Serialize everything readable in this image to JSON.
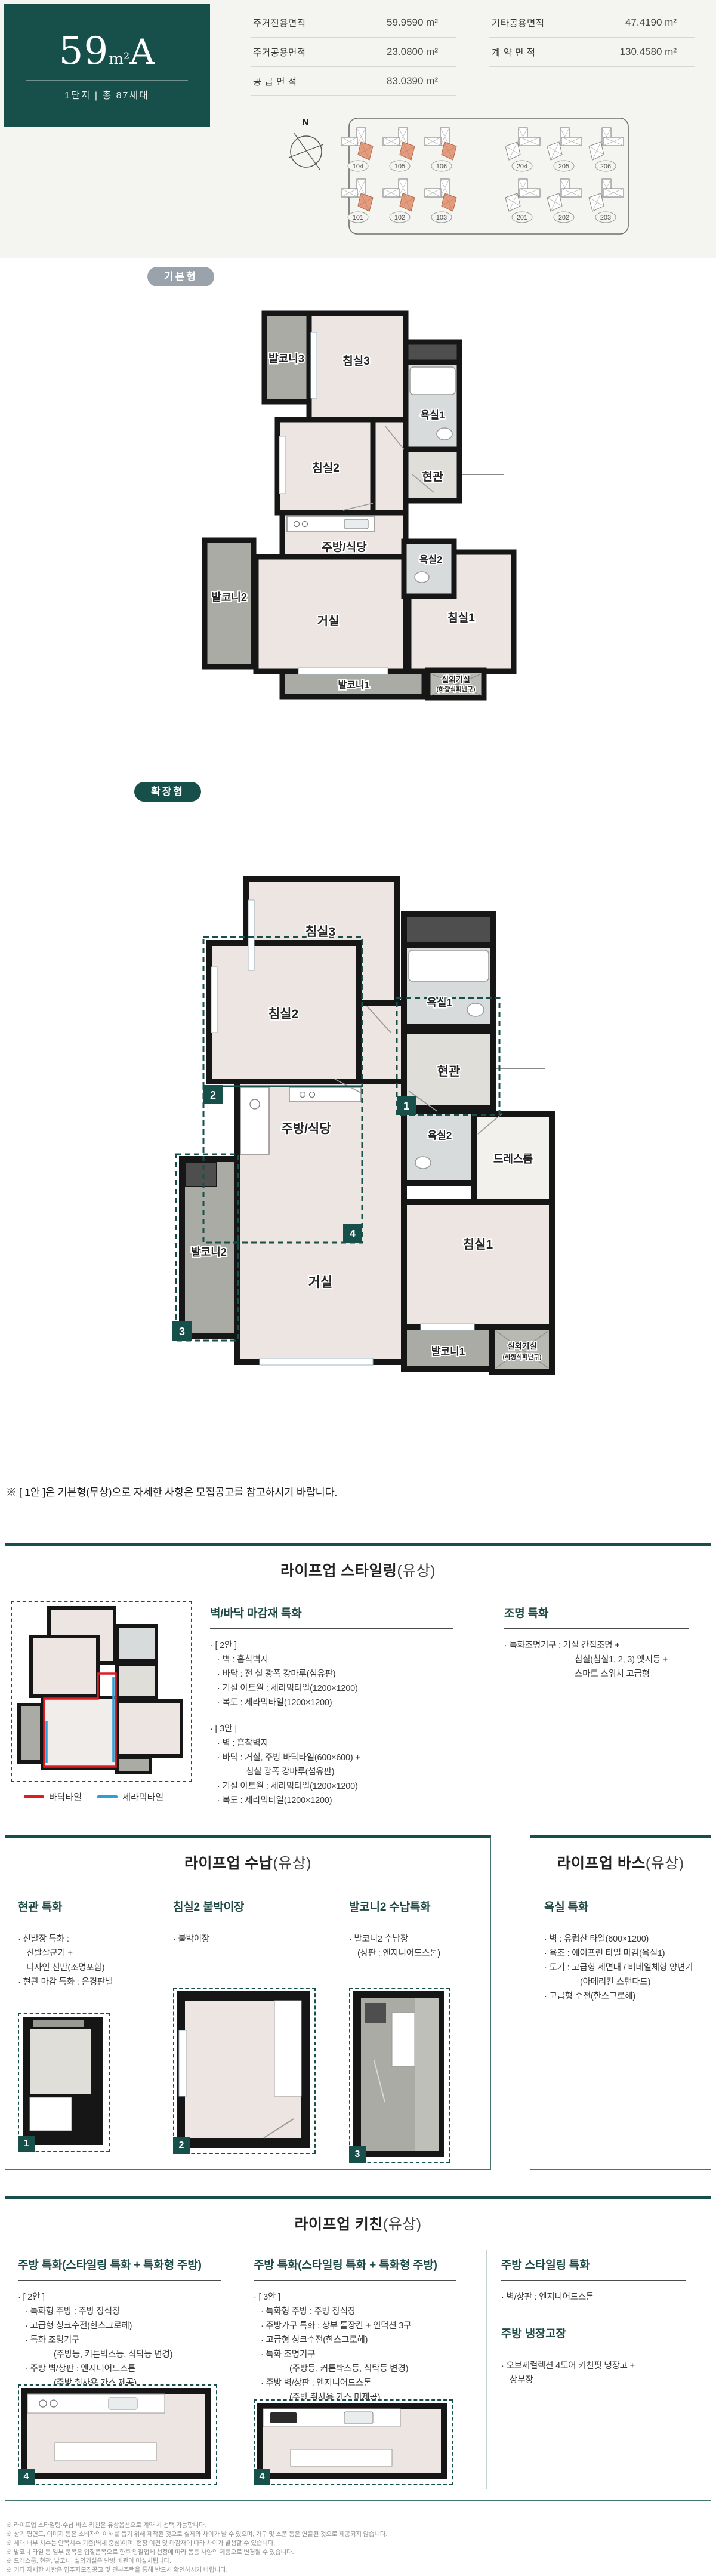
{
  "colors": {
    "accent": "#17504B",
    "badge_gray": "#9AA3AB",
    "building_highlight": "#E59B7E",
    "tile_red": "#E01B22",
    "tile_blue": "#2D9FD8"
  },
  "header": {
    "unit_num": "59",
    "unit_sup": "m²",
    "unit_type": "A",
    "subtitle": "1단지  |  총 87세대",
    "table": {
      "rows": [
        {
          "l1": "주거전용면적",
          "v1": "59.9590 m²",
          "l2": "기타공용면적",
          "v2": "47.4190 m²"
        },
        {
          "l1": "주거공용면적",
          "v1": "23.0800 m²",
          "l2": "계 약 면 적",
          "v2": "130.4580 m²"
        },
        {
          "l1": "공 급 면 적",
          "v1": "83.0390 m²",
          "l2": "",
          "v2": ""
        }
      ]
    },
    "compass": "N",
    "siteplan": {
      "top_row": [
        "104",
        "105",
        "106",
        "204",
        "205",
        "206"
      ],
      "bottom_row": [
        "101",
        "102",
        "103",
        "201",
        "202",
        "203"
      ]
    }
  },
  "badges": {
    "basic": "기본형",
    "extended": "확장형"
  },
  "rooms": {
    "balcony3": "발코니3",
    "bed3": "침실3",
    "bath1": "욕실1",
    "entry": "현관",
    "bed2": "침실2",
    "kitchen": "주방/식당",
    "bath2": "욕실2",
    "balcony2": "발코니2",
    "living": "거실",
    "bed1": "침실1",
    "balcony1": "발코니1",
    "outdoor_unit": "실외기실",
    "outdoor_unit_sub": "(하향식피난구)",
    "dress": "드레스룸"
  },
  "markers": {
    "m1": "1",
    "m2": "2",
    "m3": "3",
    "m4": "4"
  },
  "note": "※ [ 1안 ]은 기본형(무상)으로 자세한 사항은 모집공고를 참고하시기 바랍니다.",
  "styling": {
    "title": "라이프업 스타일링",
    "title_paren": "(유상)",
    "legend": [
      {
        "label": "바닥타일"
      },
      {
        "label": "세라믹타일"
      }
    ],
    "finish": {
      "header": "벽/바닥 마감재 특화",
      "items": [
        "· [ 2안 ]",
        "· 벽 : 흡착벽지",
        "· 바닥 : 전 실 광폭 강마루(섬유판)",
        "· 거실 아트월 : 세라믹타일(1200×1200)",
        "· 복도 : 세라믹타일(1200×1200)",
        "· [ 3안 ]",
        "· 벽 : 흡착벽지",
        "· 바닥 : 거실, 주방 바닥타일(600×600) +",
        "침실 광폭 강마루(섬유판)",
        "· 거실 아트월 : 세라믹타일(1200×1200)",
        "· 복도 : 세라믹타일(1200×1200)"
      ]
    },
    "lighting": {
      "header": "조명 특화",
      "items": [
        "· 특화조명기구 : 거실 간접조명 +",
        "침실(침실1, 2, 3) 엣지등 +",
        "스마트 스위치 고급형"
      ]
    }
  },
  "storage": {
    "title": "라이프업 수납",
    "title_paren": "(유상)",
    "cols": [
      {
        "header": "현관 특화",
        "items": [
          "· 신발장 특화 :",
          "신발살균기 +",
          "디자인 선반(조명포함)",
          "· 현관 마감 특화 : 은경판넬"
        ]
      },
      {
        "header": "침실2 붙박이장",
        "items": [
          "· 붙박이장"
        ]
      },
      {
        "header": "발코니2 수납특화",
        "items": [
          "· 발코니2 수납장",
          "(상판 : 엔지니어드스톤)"
        ]
      }
    ]
  },
  "bath": {
    "title": "라이프업 바스",
    "title_paren": "(유상)",
    "header": "욕실 특화",
    "items": [
      "· 벽 : 유럽산 타일(600×1200)",
      "· 욕조 : 에이프런 타일 마감(욕실1)",
      "· 도기 : 고급형 세면대 / 비데일체형 양변기",
      "(아메리칸 스탠다드)",
      "· 고급형 수전(한스그로헤)"
    ]
  },
  "kitchen": {
    "title": "라이프업 키친",
    "title_paren": "(유상)",
    "col1": {
      "header": "주방 특화(스타일링 특화 + 특화형 주방)",
      "items": [
        "· [ 2안 ]",
        "· 특화형 주방 : 주방 장식장",
        "· 고급형 싱크수전(한스그로헤)",
        "· 특화 조명기구",
        "(주방등, 커튼박스등, 식탁등 변경)",
        "· 주방 벽/상판 : 엔지니어드스톤",
        "(주방 취사용 가스 제공)"
      ]
    },
    "col2": {
      "header": "주방 특화(스타일링 특화 + 특화형 주방)",
      "items": [
        "· [ 3안 ]",
        "· 특화형 주방 : 주방 장식장",
        "· 주방가구 특화 : 상부 톨장칸 + 인덕션 3구",
        "· 고급형 싱크수전(한스그로헤)",
        "· 특화 조명기구",
        "(주방등, 커튼박스등, 식탁등 변경)",
        "· 주방 벽/상판 : 엔지니어드스톤",
        "(주방 취사용 가스 미제공)"
      ]
    },
    "col3": {
      "header": "주방 스타일링 특화",
      "items": [
        "· 벽/상판 : 엔지니어드스톤"
      ],
      "header2": "주방 냉장고장",
      "items2": [
        "· 오브제컬렉션 4도어 키친핏 냉장고 +",
        "상부장"
      ]
    }
  },
  "footnotes": [
    "※ 라이프업 스타일링·수납·바스·키친은 유상옵션으로 계약 시 선택 가능합니다.",
    "※ 상기 평면도, 이미지 등은 소비자의 이해를 돕기 위해 제작된 것으로 실제와 차이가 날 수 있으며, 가구 및 소품 등은 연출된 것으로 제공되지 않습니다.",
    "※ 세대 내부 치수는 안목치수 기준(벽체 중심)이며, 현장 여건 및 마감재에 따라 차이가 발생할 수 있습니다.",
    "※ 발코니 타일 등 일부 품목은 입찰품목으로 향후 입찰업체 선정에 따라 동등 사양의 제품으로 변경될 수 있습니다.",
    "※ 드레스룸, 현관, 발코니, 실외기실은 난방 배관이 미설치됩니다.",
    "※ 기타 자세한 사항은 입주자모집공고 및 견본주택을 통해 반드시 확인하시기 바랍니다."
  ]
}
